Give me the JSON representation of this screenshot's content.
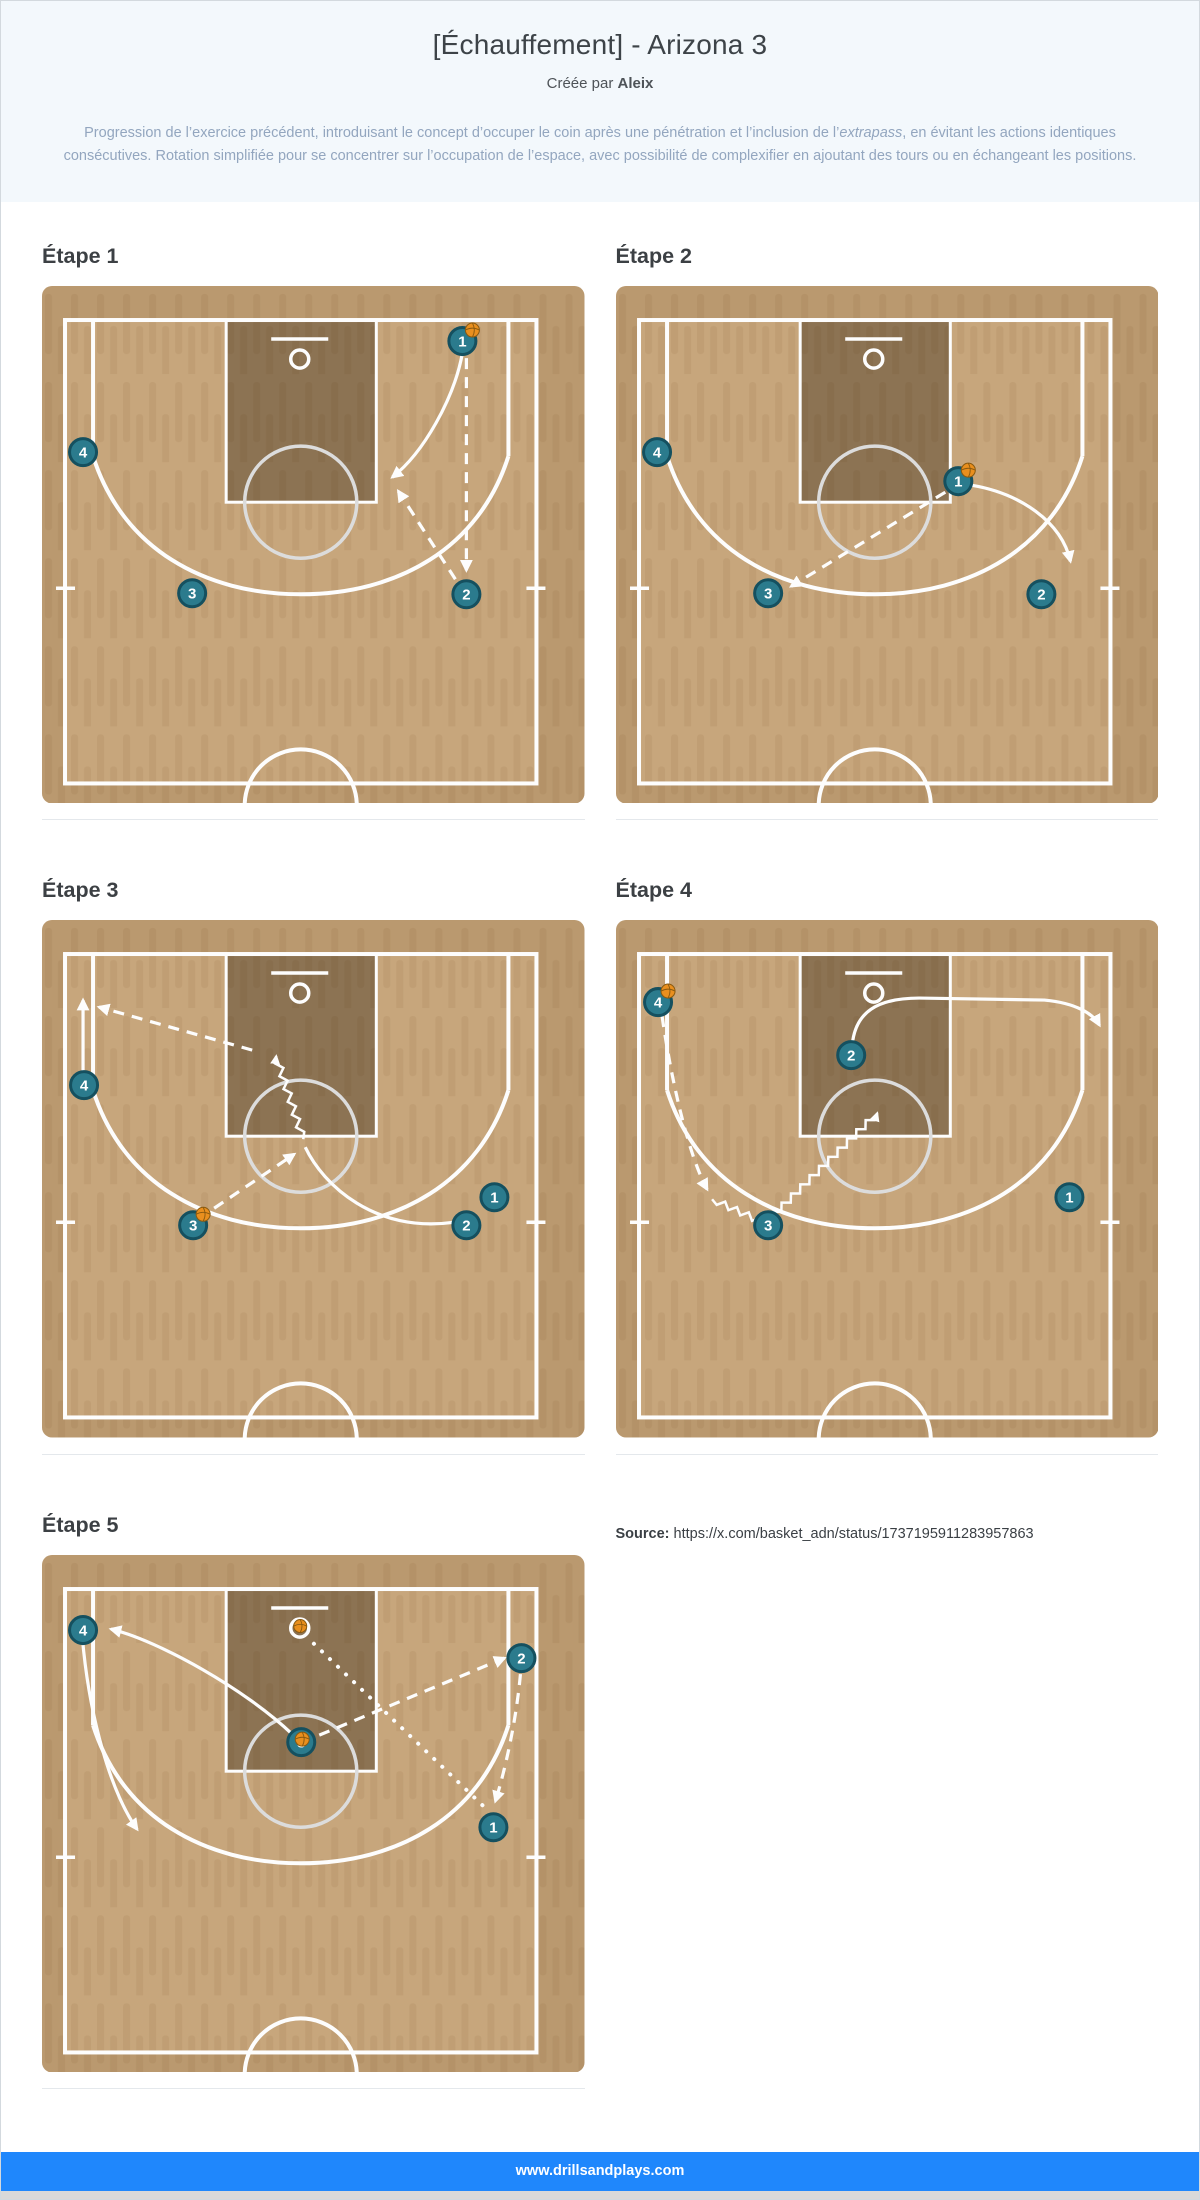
{
  "header": {
    "title": "[Échauffement] - Arizona 3",
    "credit_prefix": "Créée par",
    "credit_name": "Aleix",
    "description_before": "Progression de l’exercice précédent, introduisant le concept d’occuper le coin après une pénétration et l’inclusion de l’",
    "description_italic": "extrapass",
    "description_after": ", en évitant les actions identiques consécutives. Rotation simplifiée pour se concentrer sur l’occupation de l’espace, avec possibilité de complexifier en ajoutant des tours ou en échangeant les positions."
  },
  "colors": {
    "header_bg": "#f3f8fc",
    "footer_bg": "#1f87fc",
    "court": "#c7a67c",
    "court_stripe": "#c09e74",
    "court_margin_overlay": "rgba(120,85,45,0.16)",
    "key_overlay": "rgba(20,12,0,0.33)",
    "line": "#fdfdfd",
    "ft_circle": "#dcdcdc",
    "player": "#2b7b8d",
    "player_border": "#15505f",
    "ball": "#e98f1e",
    "ball_seam": "#8a5a10"
  },
  "steps": [
    {
      "label": "Étape 1",
      "players": [
        {
          "n": "1",
          "x": 420,
          "y": 55,
          "ball": "tr"
        },
        {
          "n": "4",
          "x": 41,
          "y": 166
        },
        {
          "n": "3",
          "x": 150,
          "y": 307
        },
        {
          "n": "2",
          "x": 424,
          "y": 308
        }
      ],
      "arrows": [
        {
          "name": "cut-arrow-1-to-elbow",
          "style": "solid",
          "d": "M420,67 C412,112 381,167 350,191",
          "head": true
        },
        {
          "name": "pass-arrow-1-to-2",
          "style": "dash",
          "d": "M424,72 L424,284",
          "head": true
        },
        {
          "name": "pass-arrow-2-to-elbow",
          "style": "dash",
          "d": "M413,293 L356,205",
          "head": true
        }
      ]
    },
    {
      "label": "Étape 2",
      "players": [
        {
          "n": "4",
          "x": 41,
          "y": 166
        },
        {
          "n": "1",
          "x": 342,
          "y": 195,
          "ball": "tr"
        },
        {
          "n": "3",
          "x": 152,
          "y": 307
        },
        {
          "n": "2",
          "x": 425,
          "y": 308
        }
      ],
      "arrows": [
        {
          "name": "cut-arrow-1-to-wing",
          "style": "solid",
          "d": "M355,199 C403,207 445,235 454,275",
          "head": true
        },
        {
          "name": "pass-arrow-1-to-3",
          "style": "dash",
          "d": "M329,206 L175,300",
          "head": true
        }
      ]
    },
    {
      "label": "Étape 3",
      "players": [
        {
          "n": "4",
          "x": 42,
          "y": 165
        },
        {
          "n": "3",
          "x": 151,
          "y": 305,
          "ball": "tr"
        },
        {
          "n": "1",
          "x": 452,
          "y": 277
        },
        {
          "n": "2",
          "x": 424,
          "y": 305
        }
      ],
      "arrows": [
        {
          "name": "cut-arrow-4-to-corner",
          "style": "solid",
          "d": "M41,152 L41,80",
          "head": true
        },
        {
          "name": "pass-arrow-kickout-to-corner",
          "style": "dash",
          "d": "M210,130 L57,87",
          "head": true
        },
        {
          "name": "cut-arrow-2-to-free-throw",
          "style": "solid",
          "d": "M411,302 C333,313 281,265 263,227",
          "head": false
        },
        {
          "name": "dribble-arrow-to-basket",
          "style": "zigzag",
          "pts": [
            [
              261,
              219
            ],
            [
              234,
              136
            ]
          ],
          "head": true
        },
        {
          "name": "pass-arrow-3-to-free-throw",
          "style": "dash",
          "d": "M172,288 L252,234",
          "head": true
        }
      ]
    },
    {
      "label": "Étape 4",
      "players": [
        {
          "n": "4",
          "x": 42,
          "y": 82,
          "ball": "tr"
        },
        {
          "n": "2",
          "x": 235,
          "y": 135
        },
        {
          "n": "3",
          "x": 152,
          "y": 305
        },
        {
          "n": "1",
          "x": 453,
          "y": 277
        }
      ],
      "arrows": [
        {
          "name": "cut-arrow-2-to-right-wing",
          "style": "solid",
          "d": "M236,125 C239,92 261,78 303,78 L428,80 C460,83 477,94 483,105",
          "head": true
        },
        {
          "name": "pass-arrow-4-to-3",
          "style": "dash",
          "d": "M46,96 C56,165 73,236 91,269",
          "head": true
        },
        {
          "name": "dribble-arrow-3-to-middle",
          "style": "zigzag",
          "pts": [
            [
              96,
              279
            ],
            [
              149,
              303
            ],
            [
              261,
              193
            ]
          ],
          "head": true
        }
      ]
    },
    {
      "label": "Étape 5",
      "ball_at_rim": true,
      "players": [
        {
          "n": "4",
          "x": 41,
          "y": 75
        },
        {
          "n": "2",
          "x": 479,
          "y": 103
        },
        {
          "n": "3",
          "x": 259,
          "y": 187,
          "ball": "c"
        },
        {
          "n": "1",
          "x": 451,
          "y": 272
        }
      ],
      "arrows": [
        {
          "name": "pass-arrow-3-to-2",
          "style": "dash",
          "d": "M277,180 L462,103",
          "head": true
        },
        {
          "name": "pass-arrow-2-to-1",
          "style": "dash",
          "d": "M478,119 C474,164 463,214 453,246",
          "head": true
        },
        {
          "name": "shot-arrow-1-to-basket",
          "style": "dot",
          "d": "M440,250 L271,88",
          "head": false
        },
        {
          "name": "cut-arrow-3-to-corner",
          "style": "solid",
          "d": "M250,179 C203,134 117,86 69,74",
          "head": true
        },
        {
          "name": "cut-arrow-4-to-wing",
          "style": "solid",
          "d": "M41,90 C48,162 68,236 95,274",
          "head": true
        }
      ]
    }
  ],
  "source": {
    "label": "Source:",
    "url": "https://x.com/basket_adn/status/1737195911283957863"
  },
  "footer": {
    "text": "www.drillsandplays.com"
  }
}
